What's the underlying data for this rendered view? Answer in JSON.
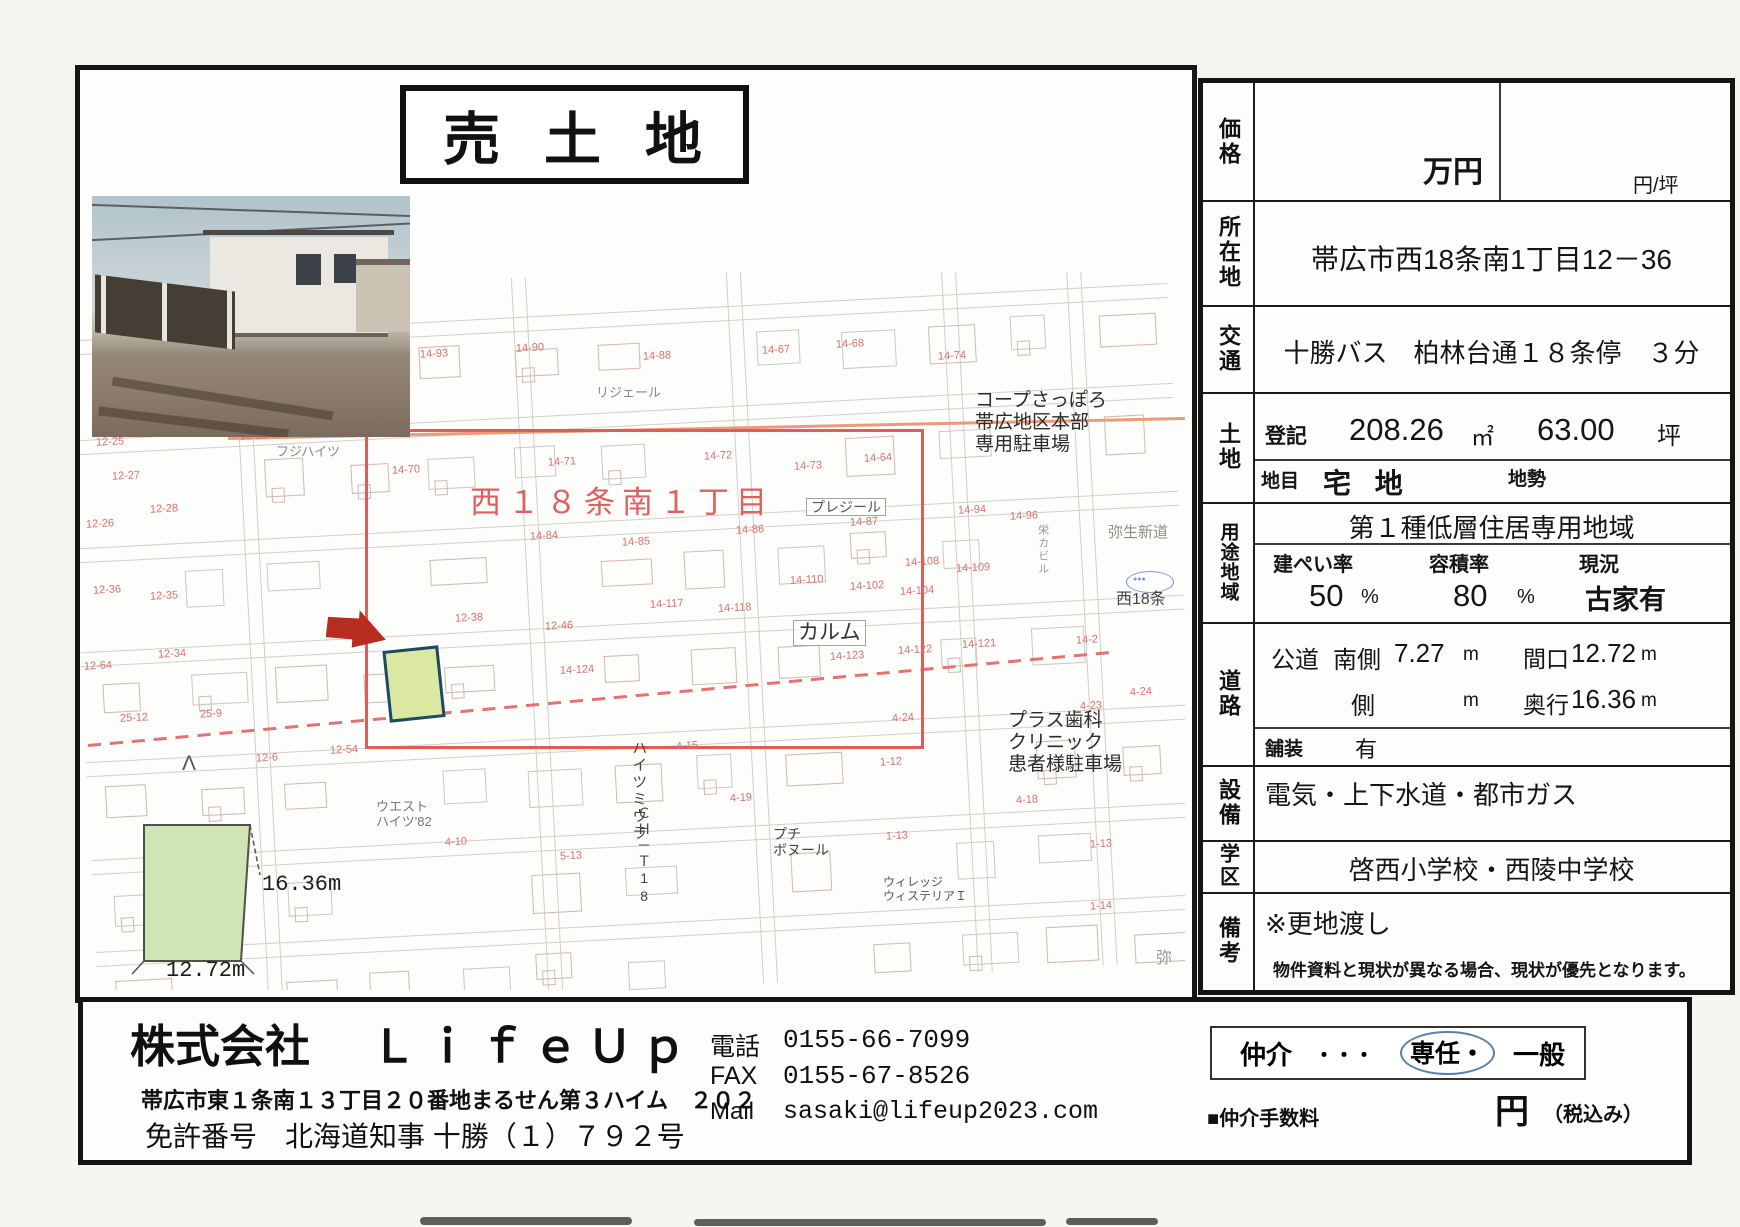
{
  "title": "売 土 地",
  "property_table": {
    "price": {
      "label": "価格",
      "unit_main": "万円",
      "unit_per_tsubo": "円/坪"
    },
    "location": {
      "label": "所在地",
      "value": "帯広市西18条南1丁目12－36"
    },
    "access": {
      "label": "交通",
      "value": "十勝バス　柏林台通１８条停　３分"
    },
    "land": {
      "label": "土地",
      "registered_label": "登記",
      "area_sqm": "208.26",
      "sqm_unit": "㎡",
      "area_tsubo": "63.00",
      "tsubo_unit": "坪",
      "category_label": "地目",
      "category": "宅 地",
      "terrain_label": "地勢"
    },
    "zoning": {
      "label": "用途地域",
      "zone": "第１種低層住居専用地域",
      "bcr_label": "建ぺい率",
      "bcr": "50",
      "bcr_unit": "%",
      "far_label": "容積率",
      "far": "80",
      "far_unit": "%",
      "status_label": "現況",
      "status": "古家有"
    },
    "road": {
      "label": "道路",
      "type": "公道",
      "side1": "南側",
      "width1": "7.27",
      "m1": "m",
      "frontage_label": "間口",
      "frontage": "12.72",
      "m2": "m",
      "side2": "側",
      "m3": "m",
      "depth_label": "奥行",
      "depth": "16.36",
      "m4": "m",
      "paving_label": "舗装",
      "paving": "有"
    },
    "utilities": {
      "label": "設備",
      "value": "電気・上下水道・都市ガス"
    },
    "school": {
      "label": "学区",
      "value": "啓西小学校・西陵中学校"
    },
    "remarks": {
      "label": "備考",
      "value": "※更地渡し",
      "note": "物件資料と現状が異なる場合、現状が優先となります。"
    }
  },
  "map": {
    "district_label": "西１８条南１丁目",
    "labels": [
      {
        "t": "コープさっぽろ\n帯広地区本部\n専用駐車場",
        "x": 975,
        "y": 390,
        "s": 19,
        "c": "#2b2b2b"
      },
      {
        "t": "プレジール",
        "x": 806,
        "y": 498,
        "s": 14,
        "c": "#555",
        "bx": true
      },
      {
        "t": "カルム",
        "x": 793,
        "y": 620,
        "s": 21,
        "c": "#333",
        "bx": true
      },
      {
        "t": "弥生新道",
        "x": 1108,
        "y": 524,
        "s": 15,
        "c": "#8d8d89"
      },
      {
        "t": "西18条",
        "x": 1116,
        "y": 591,
        "s": 16,
        "c": "#444"
      },
      {
        "t": "プラス歯科\nクリニック\n患者様駐車場",
        "x": 1008,
        "y": 710,
        "s": 19,
        "c": "#2b2b2b"
      },
      {
        "t": "ハイツミウラ",
        "x": 630,
        "y": 740,
        "s": 15,
        "c": "#444",
        "v": true
      },
      {
        "t": "ＣＨ－Ｔ18",
        "x": 636,
        "y": 806,
        "s": 14,
        "c": "#444",
        "v": true
      },
      {
        "t": "プチ\nボヌール",
        "x": 773,
        "y": 826,
        "s": 14,
        "c": "#444"
      },
      {
        "t": "ウィレッジ\nウィステリアＩ",
        "x": 883,
        "y": 876,
        "s": 12,
        "c": "#555"
      },
      {
        "t": "ウエスト\nハイツ'82",
        "x": 376,
        "y": 800,
        "s": 13,
        "c": "#777"
      },
      {
        "t": "フジハイツ",
        "x": 276,
        "y": 445,
        "s": 13,
        "c": "#888"
      },
      {
        "t": "リジェール",
        "x": 596,
        "y": 386,
        "s": 13,
        "c": "#888"
      },
      {
        "t": "栄カビル",
        "x": 1036,
        "y": 524,
        "s": 11,
        "c": "#999",
        "v": true
      },
      {
        "t": "弥",
        "x": 1156,
        "y": 950,
        "s": 16,
        "c": "#999"
      },
      {
        "t": "Λ",
        "x": 182,
        "y": 752,
        "s": 21,
        "c": "#555"
      },
      {
        "t": "●●●",
        "x": 1133,
        "y": 576,
        "s": 7,
        "c": "#7a99c4"
      }
    ],
    "lot_numbers": [
      {
        "x": 420,
        "y": 348,
        "t": "14-93"
      },
      {
        "x": 516,
        "y": 342,
        "t": "14-90"
      },
      {
        "x": 643,
        "y": 350,
        "t": "14-88"
      },
      {
        "x": 762,
        "y": 344,
        "t": "14-67"
      },
      {
        "x": 836,
        "y": 338,
        "t": "14-68"
      },
      {
        "x": 938,
        "y": 350,
        "t": "14-74"
      },
      {
        "x": 392,
        "y": 464,
        "t": "14-70"
      },
      {
        "x": 548,
        "y": 456,
        "t": "14-71"
      },
      {
        "x": 704,
        "y": 450,
        "t": "14-72"
      },
      {
        "x": 794,
        "y": 460,
        "t": "14-73"
      },
      {
        "x": 864,
        "y": 452,
        "t": "14-64"
      },
      {
        "x": 96,
        "y": 436,
        "t": "12-25"
      },
      {
        "x": 112,
        "y": 470,
        "t": "12-27"
      },
      {
        "x": 150,
        "y": 503,
        "t": "12-28"
      },
      {
        "x": 86,
        "y": 518,
        "t": "12-26"
      },
      {
        "x": 240,
        "y": 430,
        "t": "12-29"
      },
      {
        "x": 530,
        "y": 530,
        "t": "14-84"
      },
      {
        "x": 622,
        "y": 536,
        "t": "14-85"
      },
      {
        "x": 736,
        "y": 524,
        "t": "14-86"
      },
      {
        "x": 850,
        "y": 516,
        "t": "14-87"
      },
      {
        "x": 958,
        "y": 504,
        "t": "14-94"
      },
      {
        "x": 1010,
        "y": 510,
        "t": "14-96"
      },
      {
        "x": 905,
        "y": 556,
        "t": "14-108"
      },
      {
        "x": 956,
        "y": 562,
        "t": "14-109"
      },
      {
        "x": 790,
        "y": 574,
        "t": "14-110"
      },
      {
        "x": 850,
        "y": 580,
        "t": "14-102"
      },
      {
        "x": 900,
        "y": 585,
        "t": "14-104"
      },
      {
        "x": 650,
        "y": 598,
        "t": "14-117"
      },
      {
        "x": 718,
        "y": 602,
        "t": "14-118"
      },
      {
        "x": 93,
        "y": 584,
        "t": "12-36"
      },
      {
        "x": 150,
        "y": 590,
        "t": "12-35"
      },
      {
        "x": 455,
        "y": 612,
        "t": "12-38"
      },
      {
        "x": 545,
        "y": 620,
        "t": "12-46"
      },
      {
        "x": 158,
        "y": 648,
        "t": "12-34"
      },
      {
        "x": 84,
        "y": 660,
        "t": "12-64"
      },
      {
        "x": 830,
        "y": 650,
        "t": "14-123"
      },
      {
        "x": 898,
        "y": 644,
        "t": "14-122"
      },
      {
        "x": 962,
        "y": 638,
        "t": "14-121"
      },
      {
        "x": 560,
        "y": 664,
        "t": "14-124"
      },
      {
        "x": 1076,
        "y": 634,
        "t": "14-2"
      },
      {
        "x": 892,
        "y": 712,
        "t": "4-24"
      },
      {
        "x": 1080,
        "y": 700,
        "t": "4-23"
      },
      {
        "x": 1130,
        "y": 686,
        "t": "4-24"
      },
      {
        "x": 676,
        "y": 740,
        "t": "4-15"
      },
      {
        "x": 730,
        "y": 792,
        "t": "4-19"
      },
      {
        "x": 1016,
        "y": 794,
        "t": "4-18"
      },
      {
        "x": 256,
        "y": 752,
        "t": "12-6"
      },
      {
        "x": 330,
        "y": 744,
        "t": "12-54"
      },
      {
        "x": 120,
        "y": 712,
        "t": "25-12"
      },
      {
        "x": 200,
        "y": 708,
        "t": "25-9"
      },
      {
        "x": 445,
        "y": 836,
        "t": "4-10"
      },
      {
        "x": 560,
        "y": 850,
        "t": "5-13"
      },
      {
        "x": 880,
        "y": 756,
        "t": "1-12"
      },
      {
        "x": 886,
        "y": 830,
        "t": "1-13"
      },
      {
        "x": 1090,
        "y": 838,
        "t": "1-13"
      },
      {
        "x": 1090,
        "y": 900,
        "t": "1-14"
      }
    ],
    "diagram": {
      "depth_label": "16.36m",
      "width_label": "12.72m"
    }
  },
  "footer": {
    "company_prefix": "株式会社",
    "company_name": "ＬｉｆｅＵｐ",
    "address": "帯広市東１条南１３丁目２０番地まるせん第３ハイム　２０２",
    "license": "免許番号　北海道知事 十勝（１）７９２号",
    "phone_label": "電話",
    "phone": "0155-66-7099",
    "fax_label": "FAX",
    "fax": "0155-67-8526",
    "mail_label": "Mail",
    "mail": "sasaki@lifeup2023.com",
    "broker_label": "仲介",
    "broker_dots": "・・・",
    "broker_sennin": "専任・",
    "broker_ippan": "一般",
    "fee_label": "■仲介手数料",
    "yen": "円",
    "tax_note": "（税込み）"
  }
}
